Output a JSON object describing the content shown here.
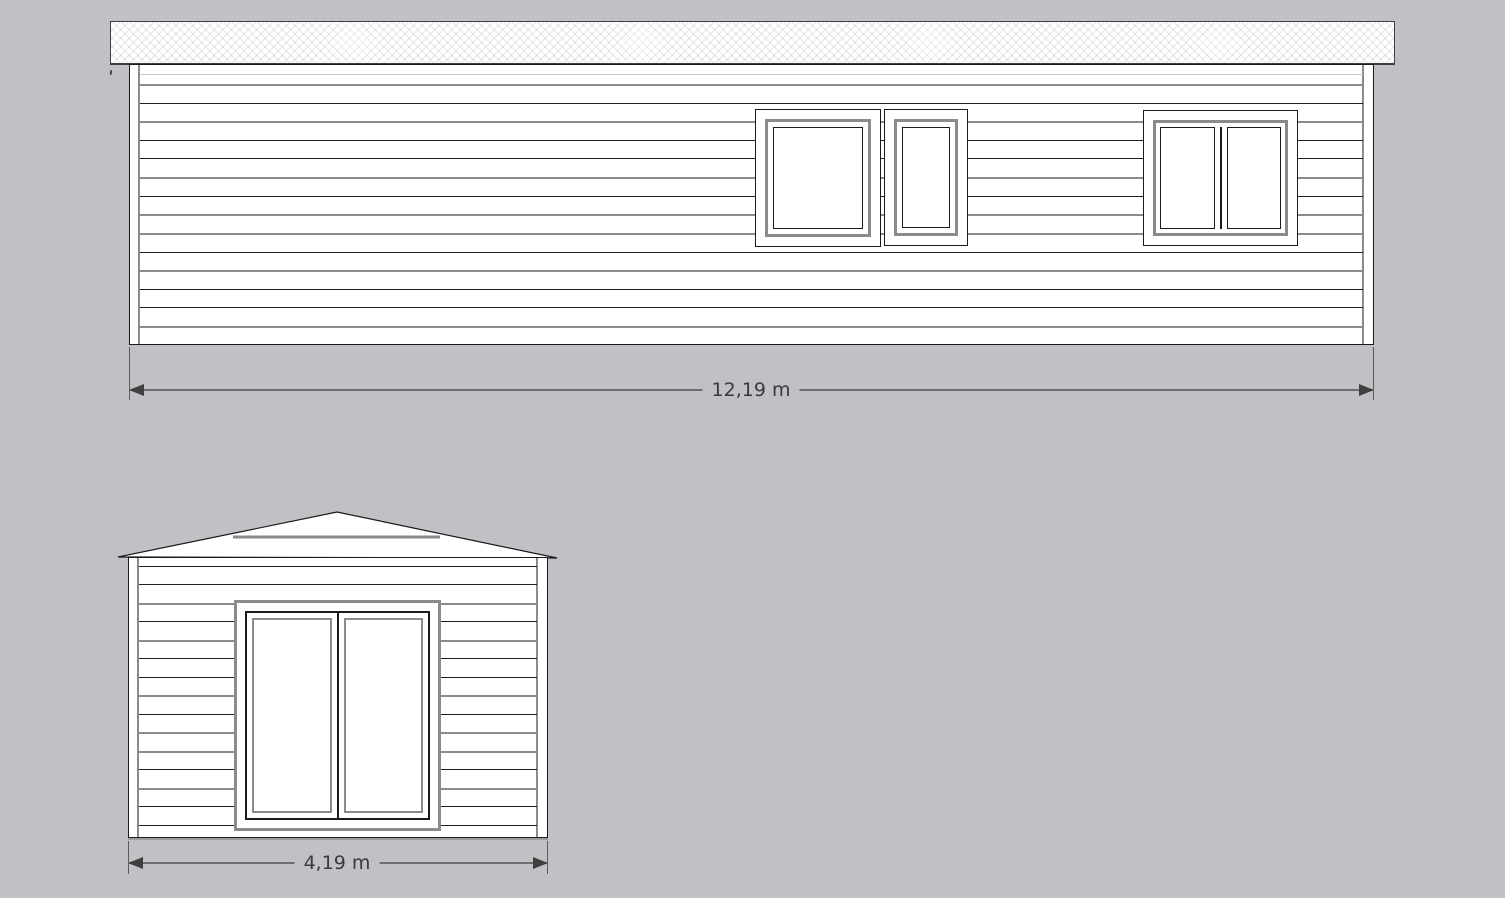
{
  "colors": {
    "background": "#c1c1c5",
    "line_black": "#1f1f1f",
    "line_gray": "#8b8b8b",
    "line_light": "#c9c9c9",
    "frame_gray": "#8b8b8b",
    "dim_line": "#6e6e6e",
    "dim_arrow": "#3f3f3f",
    "dim_text": "#3a3a3a",
    "roof_fill": "#ffffff",
    "wall_fill": "#ffffff"
  },
  "side_elevation": {
    "name": "side-elevation",
    "dimension_label": "12,19 m",
    "dimension_value_m": 12.19,
    "siding_lines": [
      {
        "y": 9,
        "c": "light"
      },
      {
        "y": 19,
        "c": "gray"
      },
      {
        "y": 38,
        "c": "black"
      },
      {
        "y": 56,
        "c": "gray"
      },
      {
        "y": 75,
        "c": "black"
      },
      {
        "y": 93,
        "c": "black"
      },
      {
        "y": 112,
        "c": "gray"
      },
      {
        "y": 131,
        "c": "black"
      },
      {
        "y": 149,
        "c": "gray"
      },
      {
        "y": 168,
        "c": "gray"
      },
      {
        "y": 187,
        "c": "black"
      },
      {
        "y": 205,
        "c": "gray"
      },
      {
        "y": 224,
        "c": "black"
      },
      {
        "y": 242,
        "c": "black"
      },
      {
        "y": 261,
        "c": "gray"
      }
    ]
  },
  "gable_elevation": {
    "name": "gable-elevation",
    "dimension_label": "4,19 m",
    "dimension_value_m": 4.19,
    "siding_lines": [
      {
        "y": 8,
        "c": "black"
      },
      {
        "y": 26,
        "c": "black"
      },
      {
        "y": 45,
        "c": "gray"
      },
      {
        "y": 63,
        "c": "black"
      },
      {
        "y": 82,
        "c": "gray"
      },
      {
        "y": 100,
        "c": "black"
      },
      {
        "y": 119,
        "c": "black"
      },
      {
        "y": 137,
        "c": "gray"
      },
      {
        "y": 156,
        "c": "black"
      },
      {
        "y": 174,
        "c": "gray"
      },
      {
        "y": 193,
        "c": "gray"
      },
      {
        "y": 211,
        "c": "black"
      },
      {
        "y": 230,
        "c": "gray"
      },
      {
        "y": 248,
        "c": "black"
      },
      {
        "y": 267,
        "c": "black"
      }
    ]
  }
}
